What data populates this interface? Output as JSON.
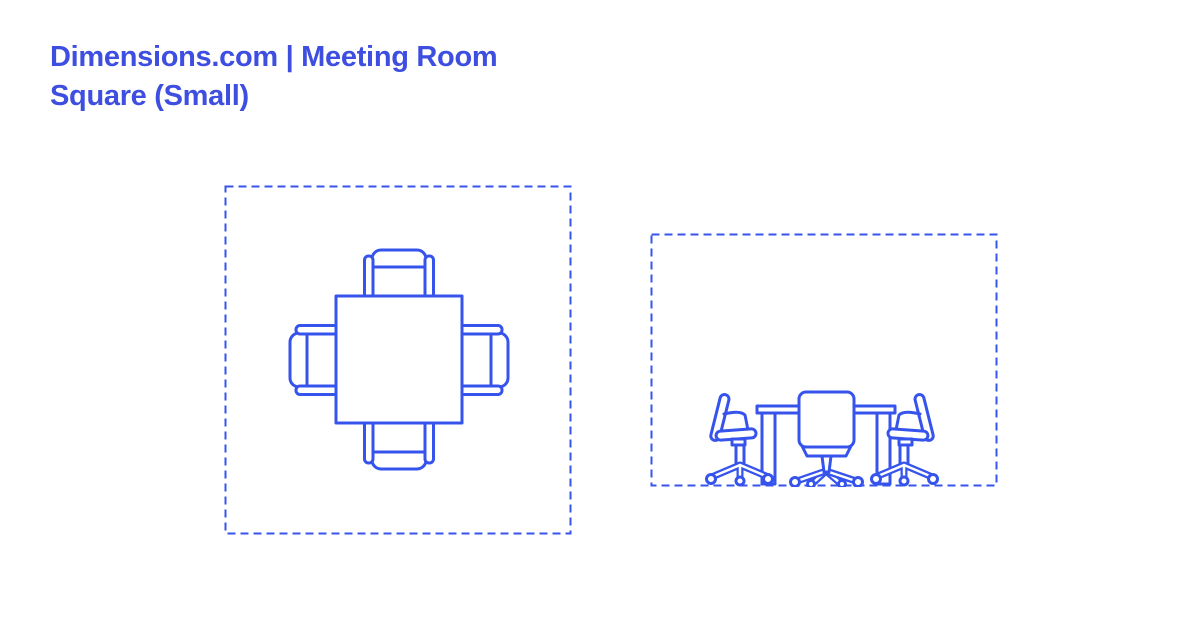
{
  "colors": {
    "background": "#ffffff",
    "title": "#3d4ee0",
    "line_art": "#3654ec"
  },
  "header": {
    "title_line1": "Dimensions.com | Meeting Room",
    "title_line2": "Square (Small)"
  }
}
